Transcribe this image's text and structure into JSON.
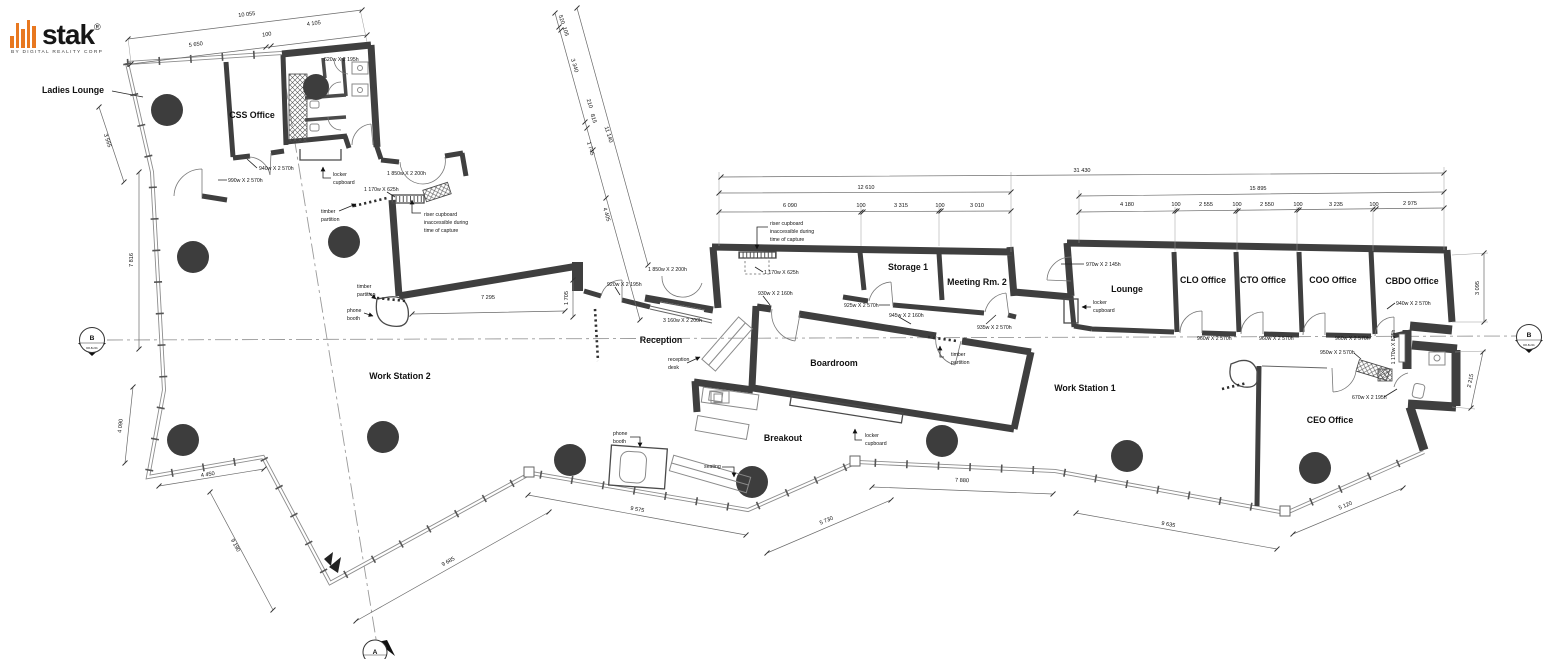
{
  "brand": {
    "name": "stak",
    "reg": "®",
    "tagline": "BY DIGITAL REALITY CORP",
    "accent": "#E87820"
  },
  "colors": {
    "wall": "#3f3f3f",
    "paper": "#ffffff"
  },
  "rooms": {
    "ladies_lounge": "Ladies Lounge",
    "css_office": "CSS Office",
    "work_station_2": "Work Station 2",
    "reception": "Reception",
    "boardroom": "Boardroom",
    "breakout": "Breakout",
    "storage_1": "Storage 1",
    "meeting_rm_2": "Meeting Rm. 2",
    "lounge": "Lounge",
    "clo_office": "CLO Office",
    "cto_office": "CTO Office",
    "coo_office": "COO Office",
    "cbdo_office": "CBDO Office",
    "work_station_1": "Work Station 1",
    "ceo_office": "CEO Office"
  },
  "ann": {
    "locker1": "locker",
    "locker2": "cupboard",
    "timber1": "timber",
    "timber2": "partition",
    "riser1": "riser cupboard",
    "riser2": "inaccessible during",
    "riser3": "time of capture",
    "phone1": "phone",
    "phone2": "booth",
    "seating": "seating",
    "rdesk1": "reception",
    "rdesk2": "desk"
  },
  "doors": {
    "d620": "620w X 2 195h",
    "d940": "940w X 2 570h",
    "d990": "990w X 2 570h",
    "d1850": "1 850w X 2 200h",
    "d1170s": "1 170w X 625h",
    "d920": "920w X 2 195h",
    "d3160": "3 160w X 2 200h",
    "d930": "930w X 2 160h",
    "d925": "925w X 2 570h",
    "d945": "945w X 2 160h",
    "d935": "935w X 2 570h",
    "d970": "970w X 2 145h",
    "d960": "960w X 2 570h",
    "d950": "950w X 2 570h",
    "d1170b": "1 170w X 825h",
    "d670": "670w X 2 195h"
  },
  "dims": {
    "d10055": "10 055",
    "d5650": "5 650",
    "d100": "100",
    "d4105": "4 105",
    "d3565": "3 565",
    "d7816": "7 816",
    "d4090": "4 090",
    "d4450": "4 450",
    "d9190": "9 190",
    "d9685": "9 685",
    "d9575": "9 575",
    "d5730": "5 730",
    "d7880": "7 880",
    "d9635": "9 635",
    "d5120": "5 120",
    "d520": "520",
    "d105": "105",
    "d3340": "3 340",
    "d210": "210",
    "d815": "815",
    "d1745": "1 745",
    "d11140": "11 140",
    "d4405": "4 405",
    "d31430": "31 430",
    "d12610": "12 610",
    "d15895": "15 895",
    "d6090": "6 090",
    "d3315": "3 315",
    "d3010": "3 010",
    "d4180": "4 180",
    "d2555": "2 555",
    "d2550": "2 550",
    "d3235": "3 235",
    "d2975": "2 975",
    "d3095": "3 095",
    "d2215": "2 215",
    "d7295": "7 295",
    "d1705": "1 705"
  },
  "markers": {
    "a": "A",
    "b": "B",
    "code": "DR-B-201"
  }
}
